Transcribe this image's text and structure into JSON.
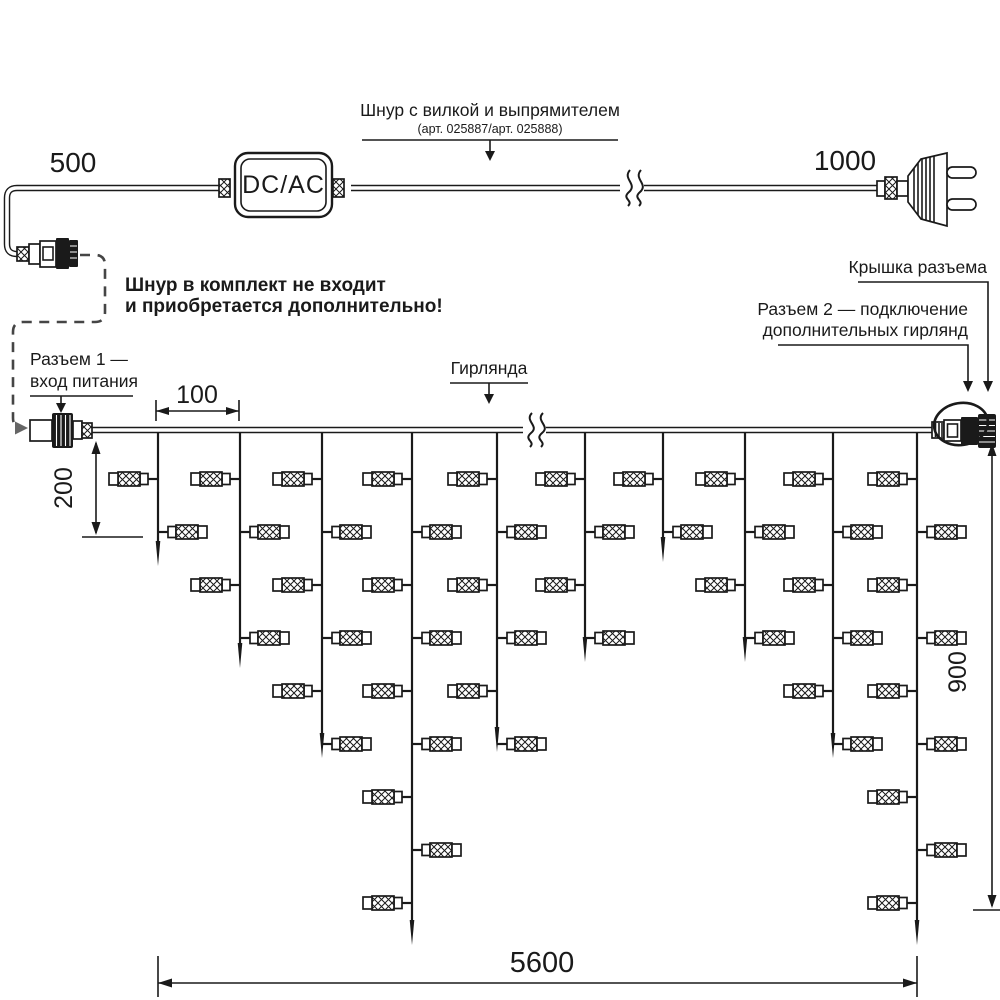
{
  "colors": {
    "ink": "#1a1a1a",
    "dash": "#454545",
    "arrow_gray": "#666666",
    "bg": "#ffffff"
  },
  "power_cord": {
    "label": "Шнур с вилкой и выпрямителем",
    "part_numbers": "(арт. 025887/арт. 025888)",
    "converter": "DC/AC",
    "dim_to_converter": "500",
    "dim_to_plug": "1000"
  },
  "note": {
    "line1": "Шнур в комплект не входит",
    "line2": "и приобретается дополнительно!"
  },
  "garland": {
    "label": "Гирлянда",
    "connector1": {
      "line1": "Разъем 1 —",
      "line2": "вход питания"
    },
    "connector2": {
      "line1": "Разъем 2 — подключение",
      "line2": "дополнительных гирлянд"
    },
    "cap_label": "Крышка разъема",
    "dims": {
      "drop_spacing": "100",
      "first_drop": "200",
      "height": "900",
      "length": "5600"
    },
    "lamp_row_start": 479,
    "lamp_row_step": 53,
    "drops": [
      {
        "x": 158,
        "lamps": 2,
        "tip": 566
      },
      {
        "x": 240,
        "lamps": 4,
        "tip": 668
      },
      {
        "x": 322,
        "lamps": 6,
        "tip": 758
      },
      {
        "x": 412,
        "lamps": 9,
        "tip": 945
      },
      {
        "x": 497,
        "lamps": 6,
        "tip": 752
      },
      {
        "x": 585,
        "lamps": 4,
        "tip": 662
      },
      {
        "x": 663,
        "lamps": 2,
        "tip": 562
      },
      {
        "x": 745,
        "lamps": 4,
        "tip": 662
      },
      {
        "x": 833,
        "lamps": 6,
        "tip": 758
      },
      {
        "x": 917,
        "lamps": 9,
        "tip": 945
      }
    ]
  }
}
